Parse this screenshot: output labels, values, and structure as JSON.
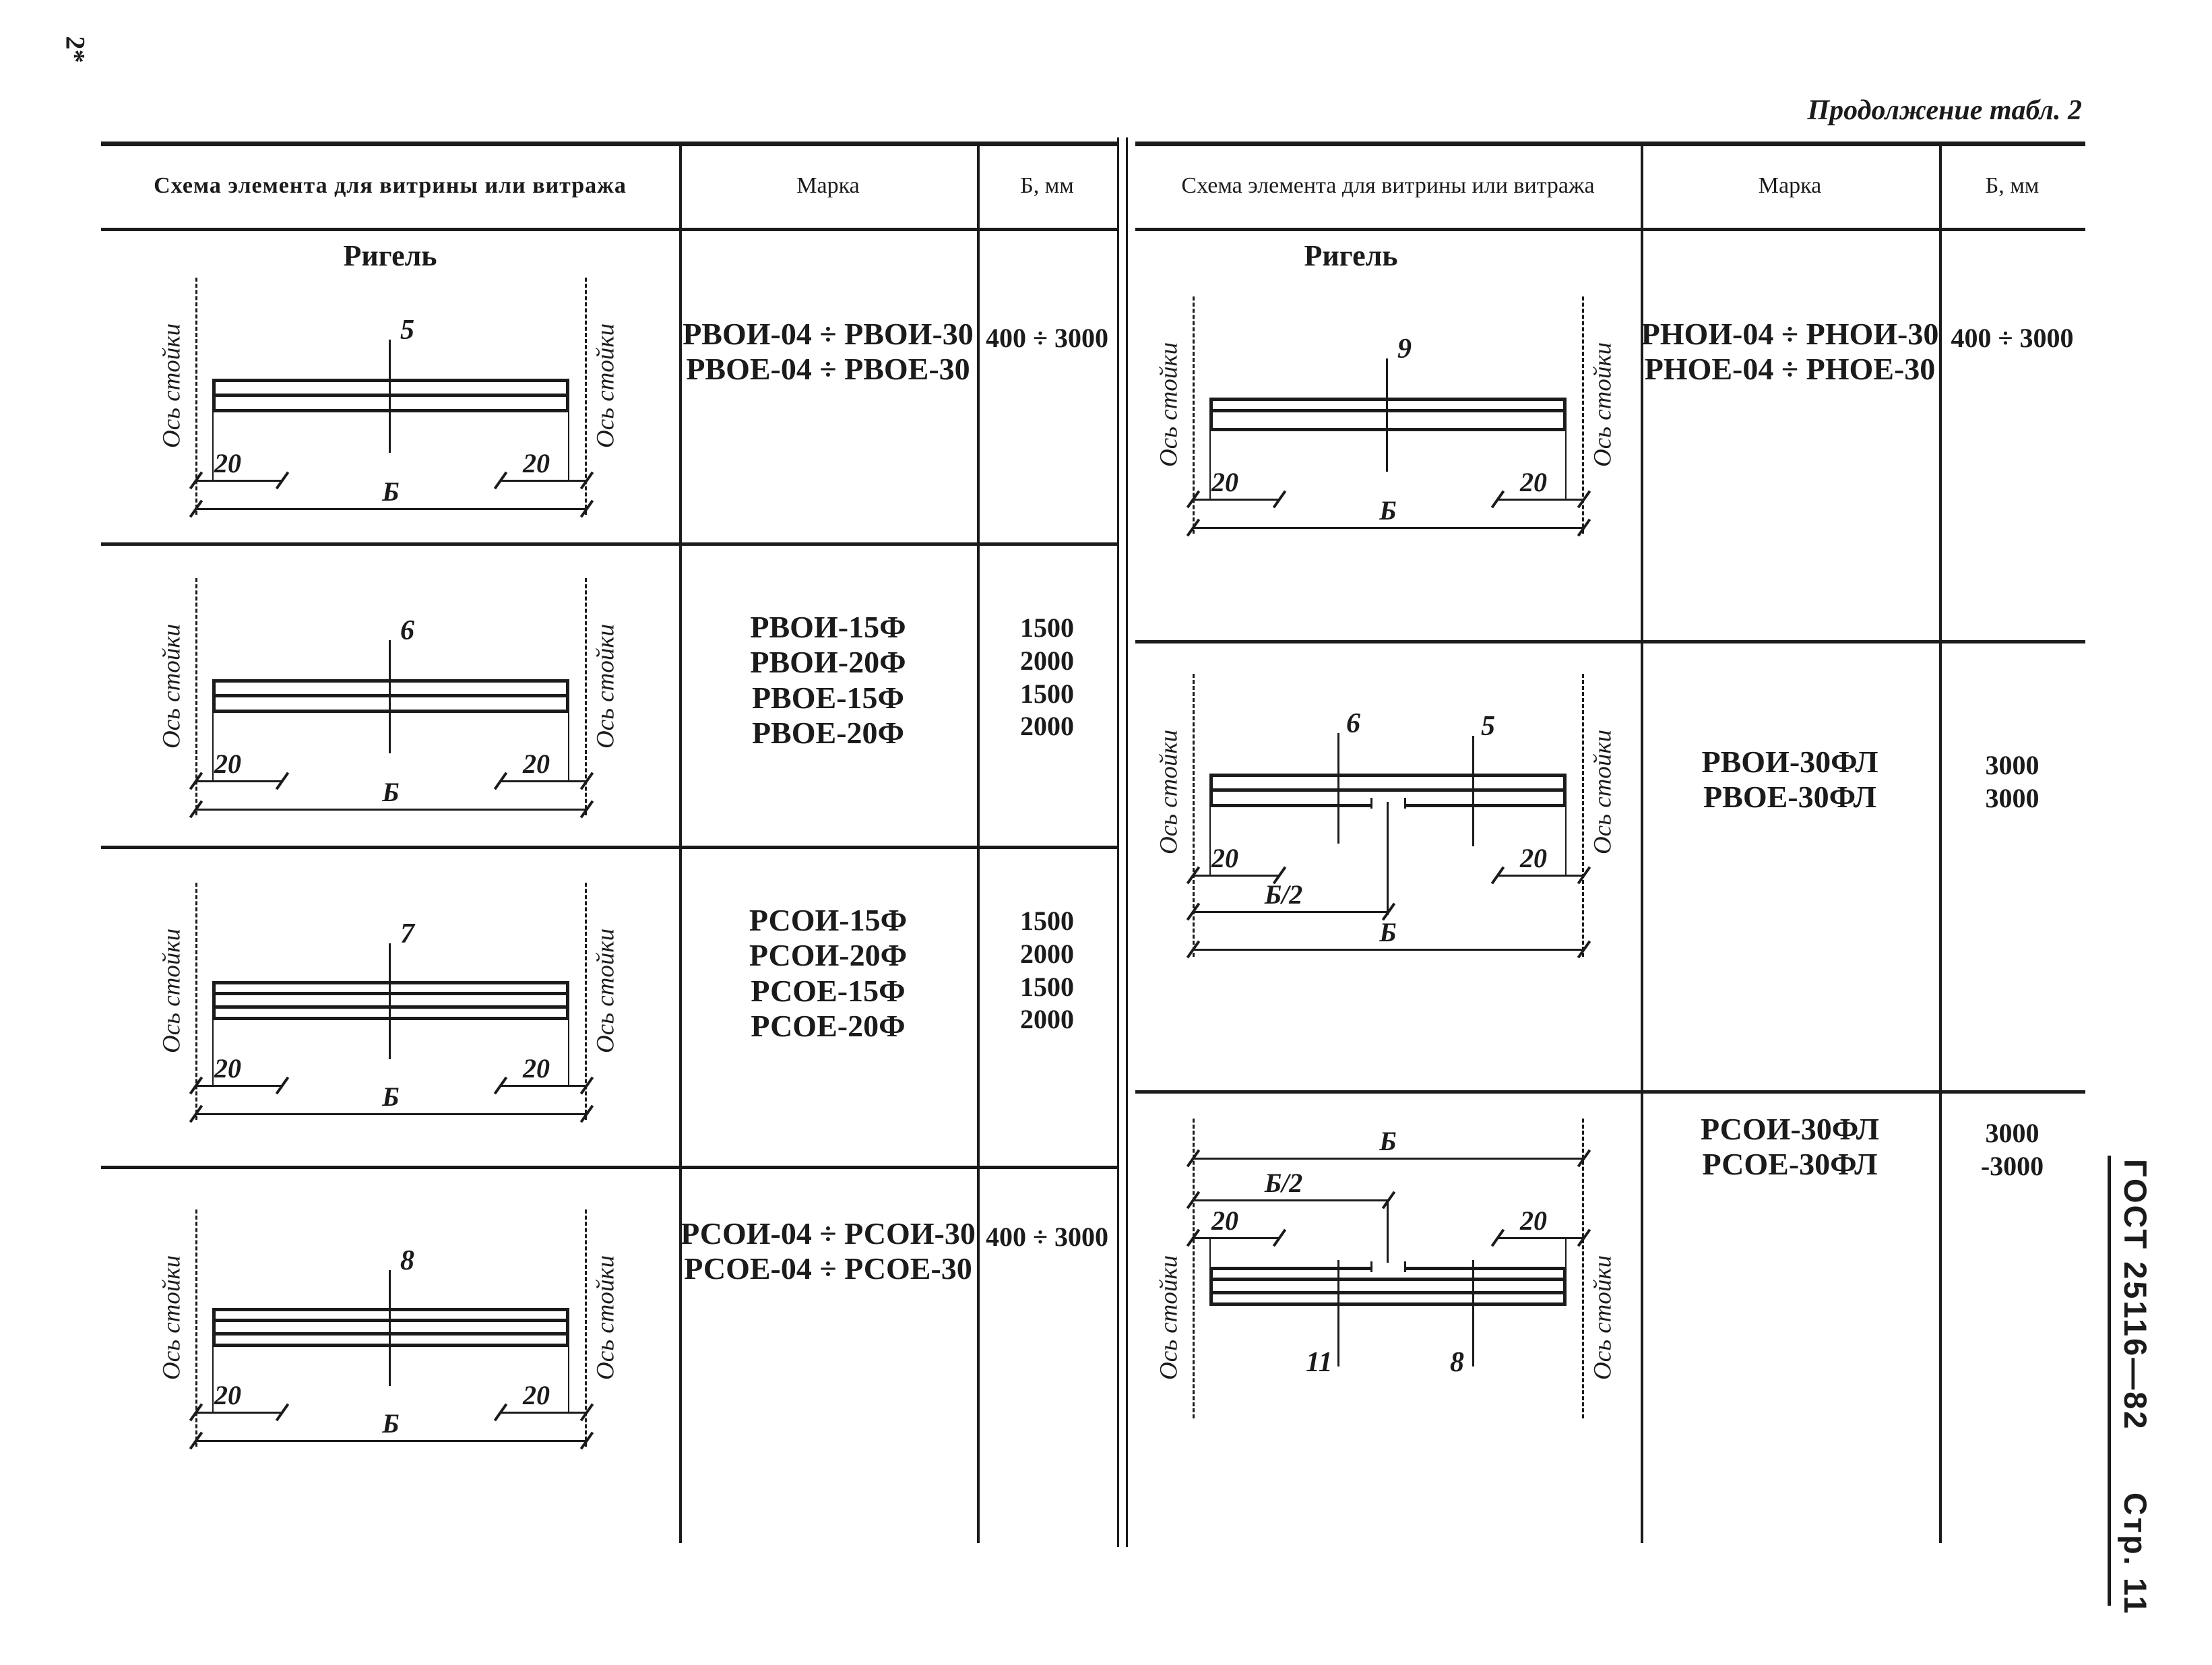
{
  "page": {
    "corner_mark": "2*",
    "continuation_note": "Продолжение табл. 2",
    "footer_gost": "ГОСТ 25116—82",
    "footer_page": "Стр. 11"
  },
  "header": {
    "scheme": "Схема элемента для витрины или витража",
    "mark": "Марка",
    "b_mm": "Б, мм"
  },
  "labels": {
    "section_title": "Ригель",
    "axis": "Ось стойки",
    "dim_end": "20",
    "dim_total": "Б",
    "dim_half": "Б/2"
  },
  "left_table": {
    "rows": [
      {
        "tick": "5",
        "marks": [
          "РВОИ-04 ÷ РВОИ-30",
          "РВОЕ-04 ÷ РВОЕ-30"
        ],
        "b": [
          "400 ÷ 3000"
        ]
      },
      {
        "tick": "6",
        "marks": [
          "РВОИ-15Ф",
          "РВОИ-20Ф",
          "РВОЕ-15Ф",
          "РВОЕ-20Ф"
        ],
        "b": [
          "1500",
          "2000",
          "1500",
          "2000"
        ]
      },
      {
        "tick": "7",
        "marks": [
          "РСОИ-15Ф",
          "РСОИ-20Ф",
          "РСОЕ-15Ф",
          "РСОЕ-20Ф"
        ],
        "b": [
          "1500",
          "2000",
          "1500",
          "2000"
        ]
      },
      {
        "tick": "8",
        "marks": [
          "РСОИ-04 ÷ РСОИ-30",
          "РСОЕ-04 ÷ РСОЕ-30"
        ],
        "b": [
          "400 ÷ 3000"
        ]
      }
    ]
  },
  "right_table": {
    "rows": [
      {
        "tick": "9",
        "marks": [
          "РНОИ-04 ÷ РНОИ-30",
          "РНОЕ-04 ÷ РНОЕ-30"
        ],
        "b": [
          "400 ÷ 3000"
        ]
      },
      {
        "tick_a": "6",
        "tick_b": "5",
        "marks": [
          "РВОИ-30ФЛ",
          "РВОЕ-30ФЛ"
        ],
        "b": [
          "3000",
          "3000"
        ]
      },
      {
        "tick_a": "11",
        "tick_b": "8",
        "marks": [
          "РСОИ-30ФЛ",
          "РСОЕ-30ФЛ"
        ],
        "b": [
          "3000",
          "-3000"
        ]
      }
    ]
  }
}
